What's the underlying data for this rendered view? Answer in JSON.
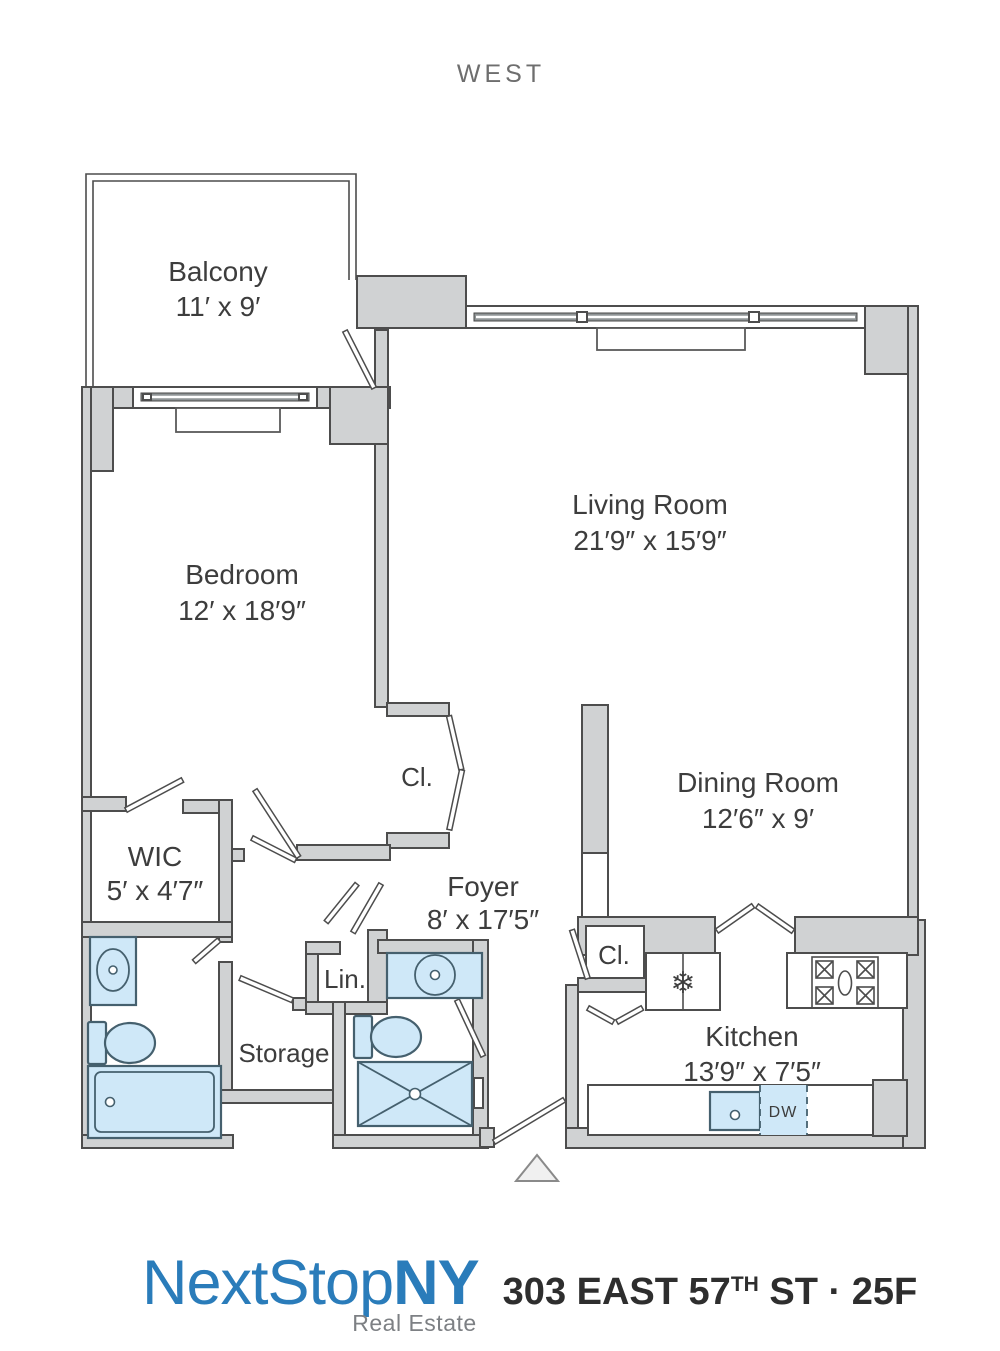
{
  "orientation_label": "WEST",
  "rooms": {
    "balcony": {
      "name": "Balcony",
      "dims": "11′ x 9′"
    },
    "living_room": {
      "name": "Living Room",
      "dims": "21′9″ x 15′9″"
    },
    "bedroom": {
      "name": "Bedroom",
      "dims": "12′ x 18′9″"
    },
    "dining_room": {
      "name": "Dining Room",
      "dims": "12′6″ x 9′"
    },
    "wic": {
      "name": "WIC",
      "dims": "5′ x 4′7″"
    },
    "foyer": {
      "name": "Foyer",
      "dims": "8′ x 17′5″"
    },
    "kitchen": {
      "name": "Kitchen",
      "dims": "13′9″ x 7′5″"
    },
    "bedroom_closet": {
      "name": "Cl."
    },
    "kitchen_closet": {
      "name": "Cl."
    },
    "linen_closet": {
      "name": "Lin."
    },
    "storage": {
      "name": "Storage"
    }
  },
  "fixtures": {
    "dishwasher_label": "DW",
    "refrigerator_icon": "❄"
  },
  "footer": {
    "brand_name_1": "NextStop",
    "brand_name_2": "NY",
    "brand_tagline": "Real Estate",
    "address_street": "303 EAST 57",
    "address_ordinal": "TH",
    "address_suffix": " ST · 25F"
  },
  "colors": {
    "wall_fill": "#d0d2d3",
    "wall_stroke": "#4d4d4d",
    "fixture_fill": "#cfe8f8",
    "brand_blue": "#2a7cba",
    "label_text": "#3d3d3d"
  }
}
